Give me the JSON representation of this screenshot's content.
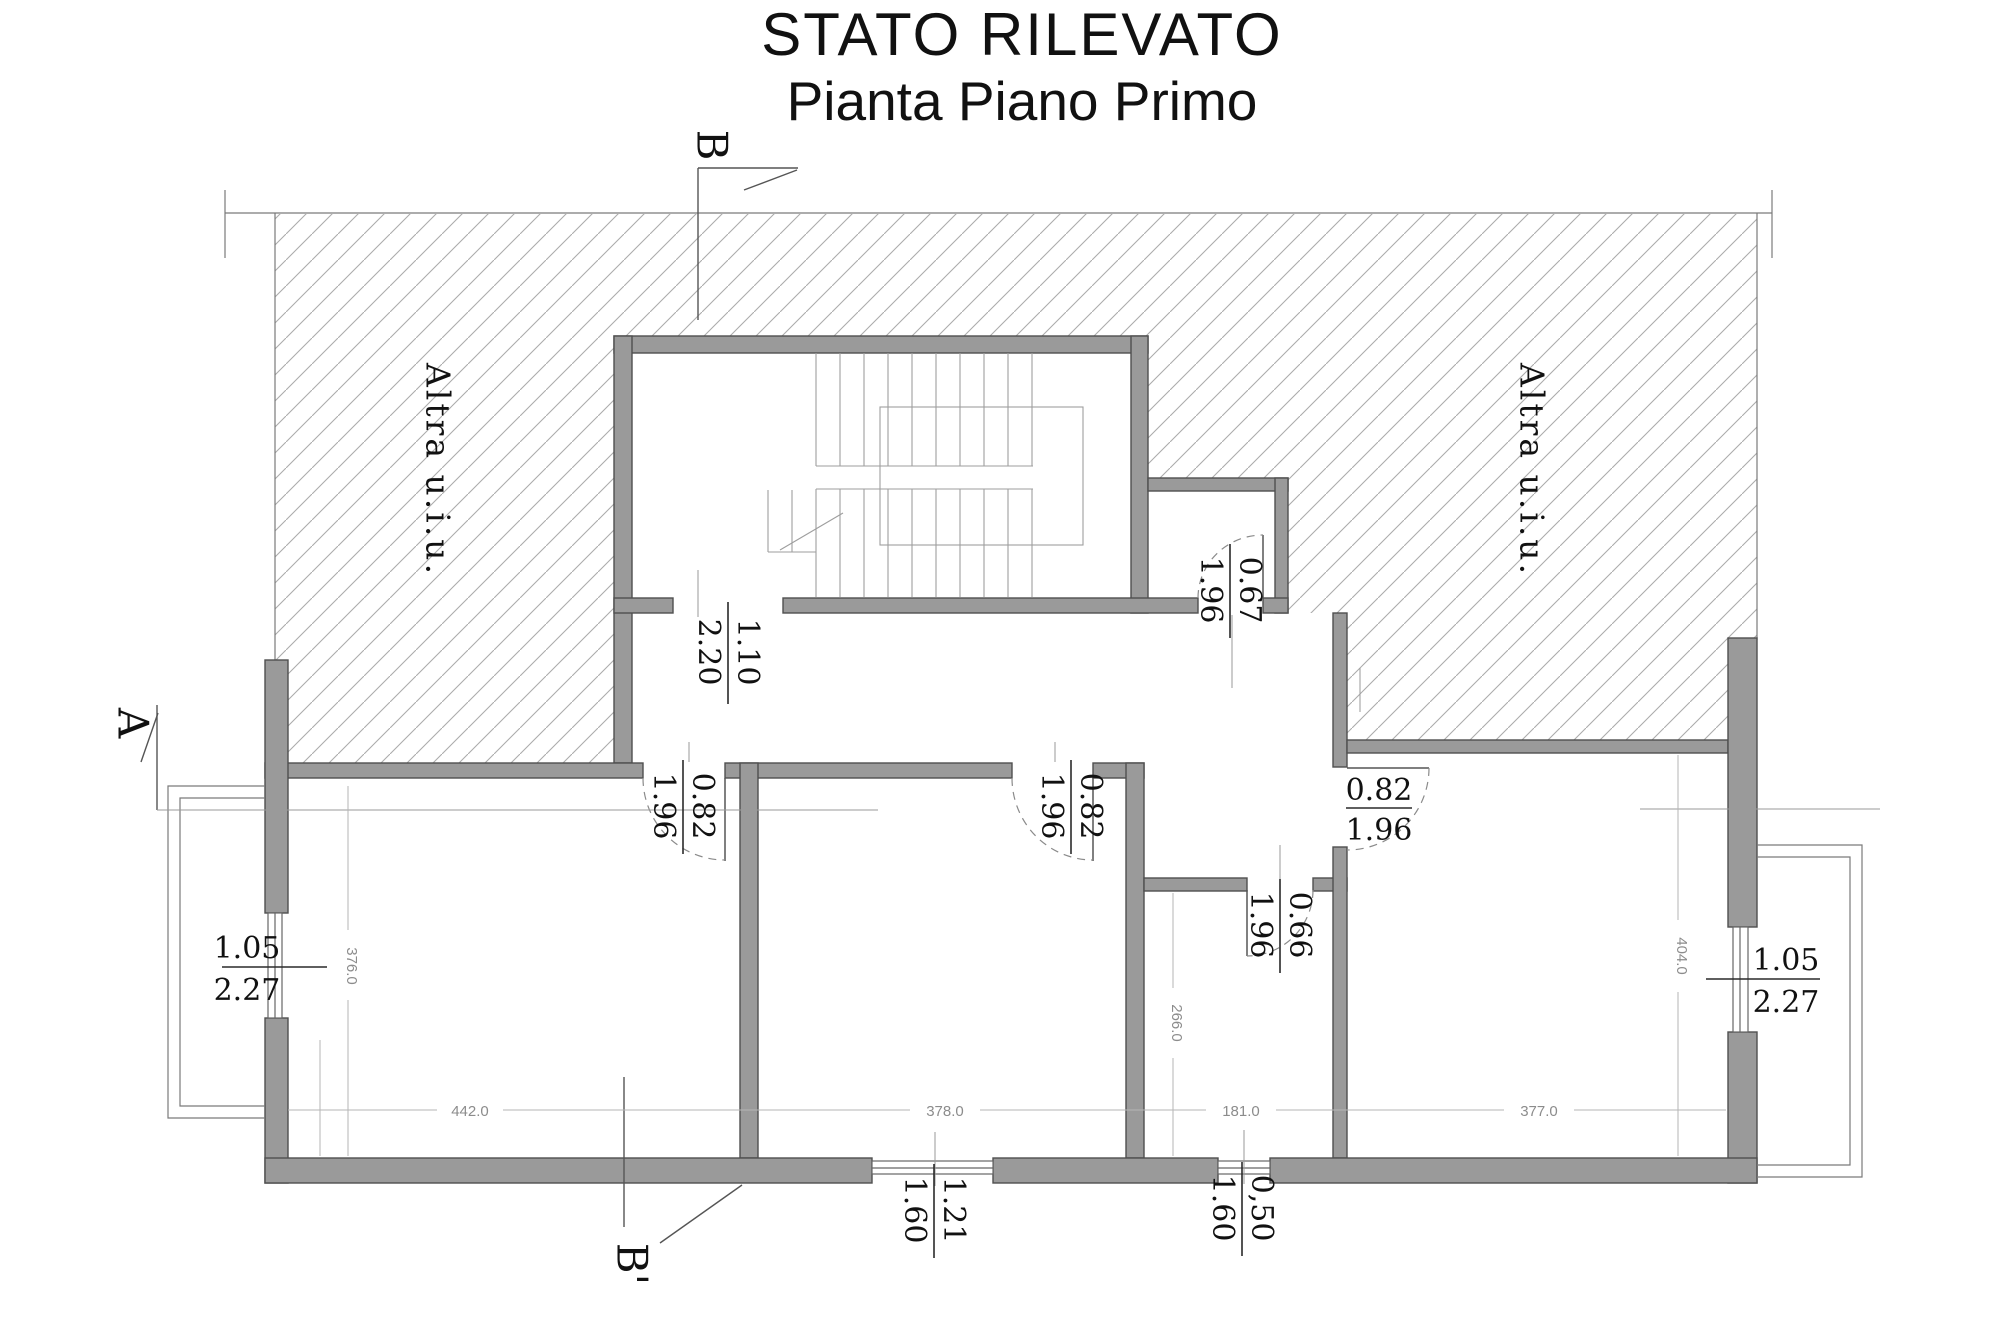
{
  "title": {
    "line1": "STATO RILEVATO",
    "line2": "Pianta Piano Primo"
  },
  "section_markers": {
    "top": "B",
    "bottom": "B'",
    "left": "A"
  },
  "area_labels": {
    "left": "Altra u.i.u.",
    "right": "Altra u.i.u."
  },
  "door_dimensions": [
    {
      "id": "stairwell-door",
      "width": "1.10",
      "height": "2.20"
    },
    {
      "id": "storage-door",
      "width": "0.67",
      "height": "1.96"
    },
    {
      "id": "left-room-door",
      "width": "0.82",
      "height": "1.96"
    },
    {
      "id": "middle-room-door",
      "width": "0.82",
      "height": "1.96"
    },
    {
      "id": "right-room-door",
      "width": "0.82",
      "height": "1.96"
    },
    {
      "id": "small-room-door",
      "width": "0.66",
      "height": "1.96"
    }
  ],
  "window_dimensions": [
    {
      "id": "left-window",
      "width": "1.05",
      "height": "2.27"
    },
    {
      "id": "right-window",
      "width": "1.05",
      "height": "2.27"
    },
    {
      "id": "bottom-middle-window",
      "width": "1.21",
      "height": "1.60"
    },
    {
      "id": "bottom-small-window",
      "width": "0,50",
      "height": "1.60"
    }
  ],
  "room_dimensions": {
    "left_width": "442.0",
    "left_height": "376.0",
    "middle_width": "378.0",
    "small_width": "181.0",
    "small_height": "266.0",
    "right_width": "377.0",
    "right_height": "404.0"
  },
  "colors": {
    "wall": "#9a9a9a",
    "wall_edge": "#4f4f4f",
    "hatch": "#ababab",
    "text": "#111111",
    "dim_text": "#8c8c8c"
  }
}
